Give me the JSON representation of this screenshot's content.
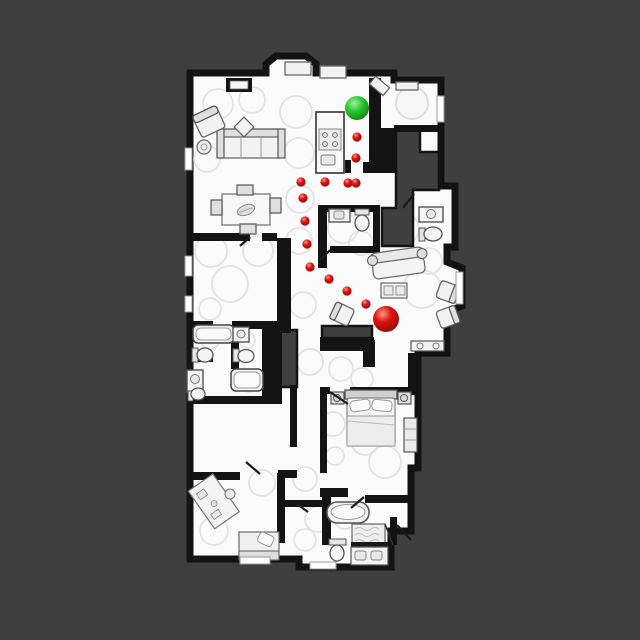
{
  "map": {
    "background_color": "#3f3f3f",
    "floor_color": "#fbfbfb",
    "wall_color": "#131313",
    "unexplored_color": "#3f3f3f"
  },
  "markers": {
    "goal": {
      "x": 357,
      "y": 108,
      "radius": 12,
      "colors": {
        "highlight": "#a0f098",
        "base": "#27c62c",
        "rim": "#0b7a10"
      }
    },
    "agent": {
      "x": 386,
      "y": 319,
      "radius": 13,
      "colors": {
        "highlight": "#ff9a86",
        "base": "#df1313",
        "rim": "#8c0606"
      }
    },
    "waypoint_radius": 4.6,
    "waypoints": [
      {
        "x": 357,
        "y": 137
      },
      {
        "x": 356,
        "y": 158
      },
      {
        "x": 301,
        "y": 182
      },
      {
        "x": 325,
        "y": 182
      },
      {
        "x": 348,
        "y": 183
      },
      {
        "x": 356,
        "y": 183
      },
      {
        "x": 303,
        "y": 198
      },
      {
        "x": 305,
        "y": 221
      },
      {
        "x": 307,
        "y": 244
      },
      {
        "x": 310,
        "y": 267
      },
      {
        "x": 329,
        "y": 279
      },
      {
        "x": 347,
        "y": 291
      },
      {
        "x": 366,
        "y": 304
      }
    ]
  }
}
